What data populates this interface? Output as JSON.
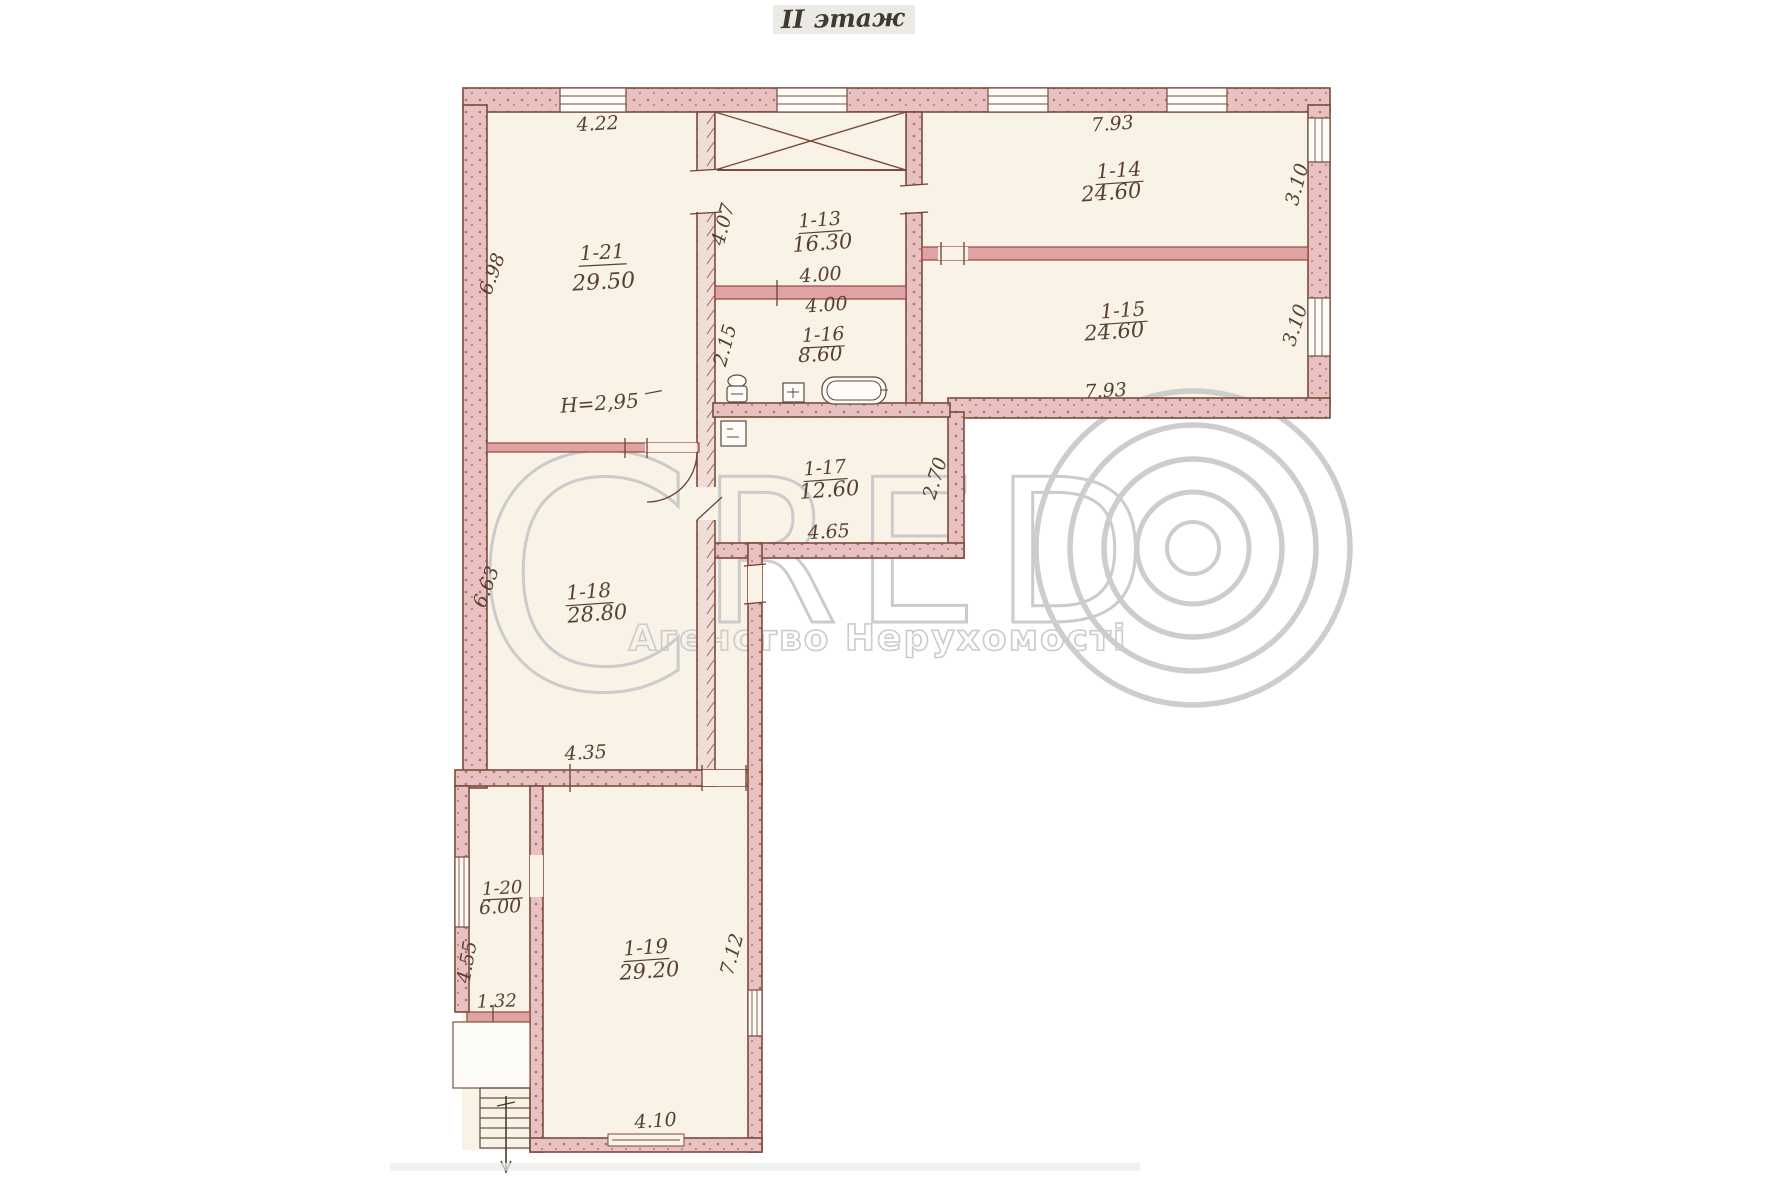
{
  "title": "II этаж",
  "rooms": [
    {
      "id": "1-21",
      "area": "29.50"
    },
    {
      "id": "1-13",
      "area": "16.30"
    },
    {
      "id": "1-14",
      "area": "24.60"
    },
    {
      "id": "1-15",
      "area": "24.60"
    },
    {
      "id": "1-16",
      "area": "8.60"
    },
    {
      "id": "1-17",
      "area": "12.60"
    },
    {
      "id": "1-18",
      "area": "28.80"
    },
    {
      "id": "1-19",
      "area": "29.20"
    },
    {
      "id": "1-20",
      "area": "6.00"
    }
  ],
  "dimensions": {
    "w_1_21": "4.22",
    "h_1_21": "6.98",
    "w_1_14": "7.93",
    "h_1_14": "3.10",
    "w_1_15": "7.93",
    "h_1_15": "3.10",
    "h_1_13": "4.07",
    "w_1_13": "4.00",
    "w_1_16": "4.00",
    "h_1_16": "2.15",
    "ceiling_height": "H=2,95",
    "w_1_17": "4.65",
    "h_1_17": "2.70",
    "h_1_18": "6.63",
    "w_1_18": "4.35",
    "h_1_20": "4.55",
    "w_1_20": "1.32",
    "h_1_19": "7.12",
    "w_1_19": "4.10"
  },
  "watermark": {
    "letter_c": "C",
    "letters_red": "RED",
    "tagline": "Агенство Нерухомості"
  },
  "colors": {
    "paper": "#f8f2e7",
    "wall_fill": "#eac1c1",
    "wall_line": "#7b4a3c",
    "thin_wall": "#dfa3a4",
    "ink": "#584030",
    "watermark": "#cbcbcb"
  }
}
